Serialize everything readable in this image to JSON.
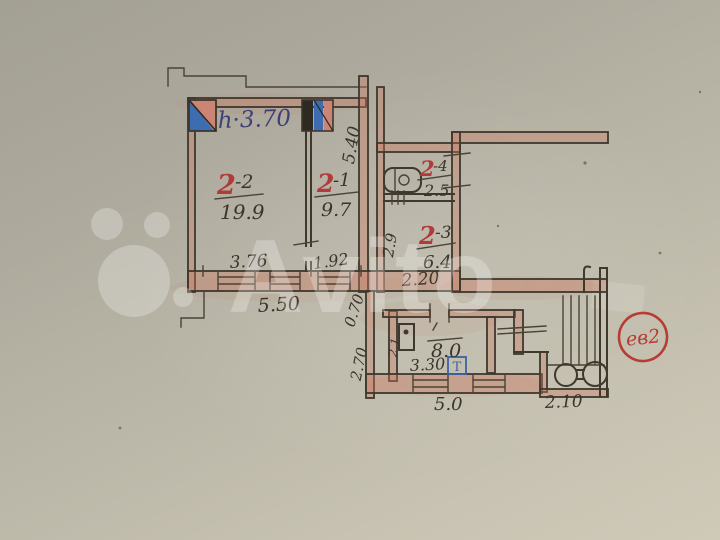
{
  "photo": {
    "watermark_text": "Avito",
    "stamp_text": "ев2"
  },
  "plan": {
    "height_note": "h·3.70",
    "rooms": {
      "r22": {
        "num": "2",
        "suffix": "-2",
        "area": "19.9"
      },
      "r21": {
        "num": "2",
        "suffix": "-1",
        "area": "9.7"
      },
      "r24": {
        "num": "2",
        "suffix": "-4",
        "area": "2.5"
      },
      "r23": {
        "num": "2",
        "suffix": "-3",
        "area": "6.4"
      },
      "kitchen": {
        "area": "8.0"
      }
    },
    "dims": {
      "v540": "5.40",
      "w376": "3.76",
      "w192": "1.92",
      "w550": "5.50",
      "c070": "0.70",
      "c270": "2.70",
      "v29": "2.9",
      "w220": "2.20",
      "w330": "3.30",
      "w50": "5.0",
      "w210": "2.10"
    },
    "fixtures": {
      "stove_label": "Т",
      "sink_label": "2.1"
    }
  },
  "colors": {
    "ink": "#3e382d",
    "red_ink": "#b13a3a",
    "blue_ink": "#3f3f78",
    "stamp_red": "#b63c34",
    "vent_blue": "#3d6cb0",
    "vent_pink": "#cc8574"
  }
}
